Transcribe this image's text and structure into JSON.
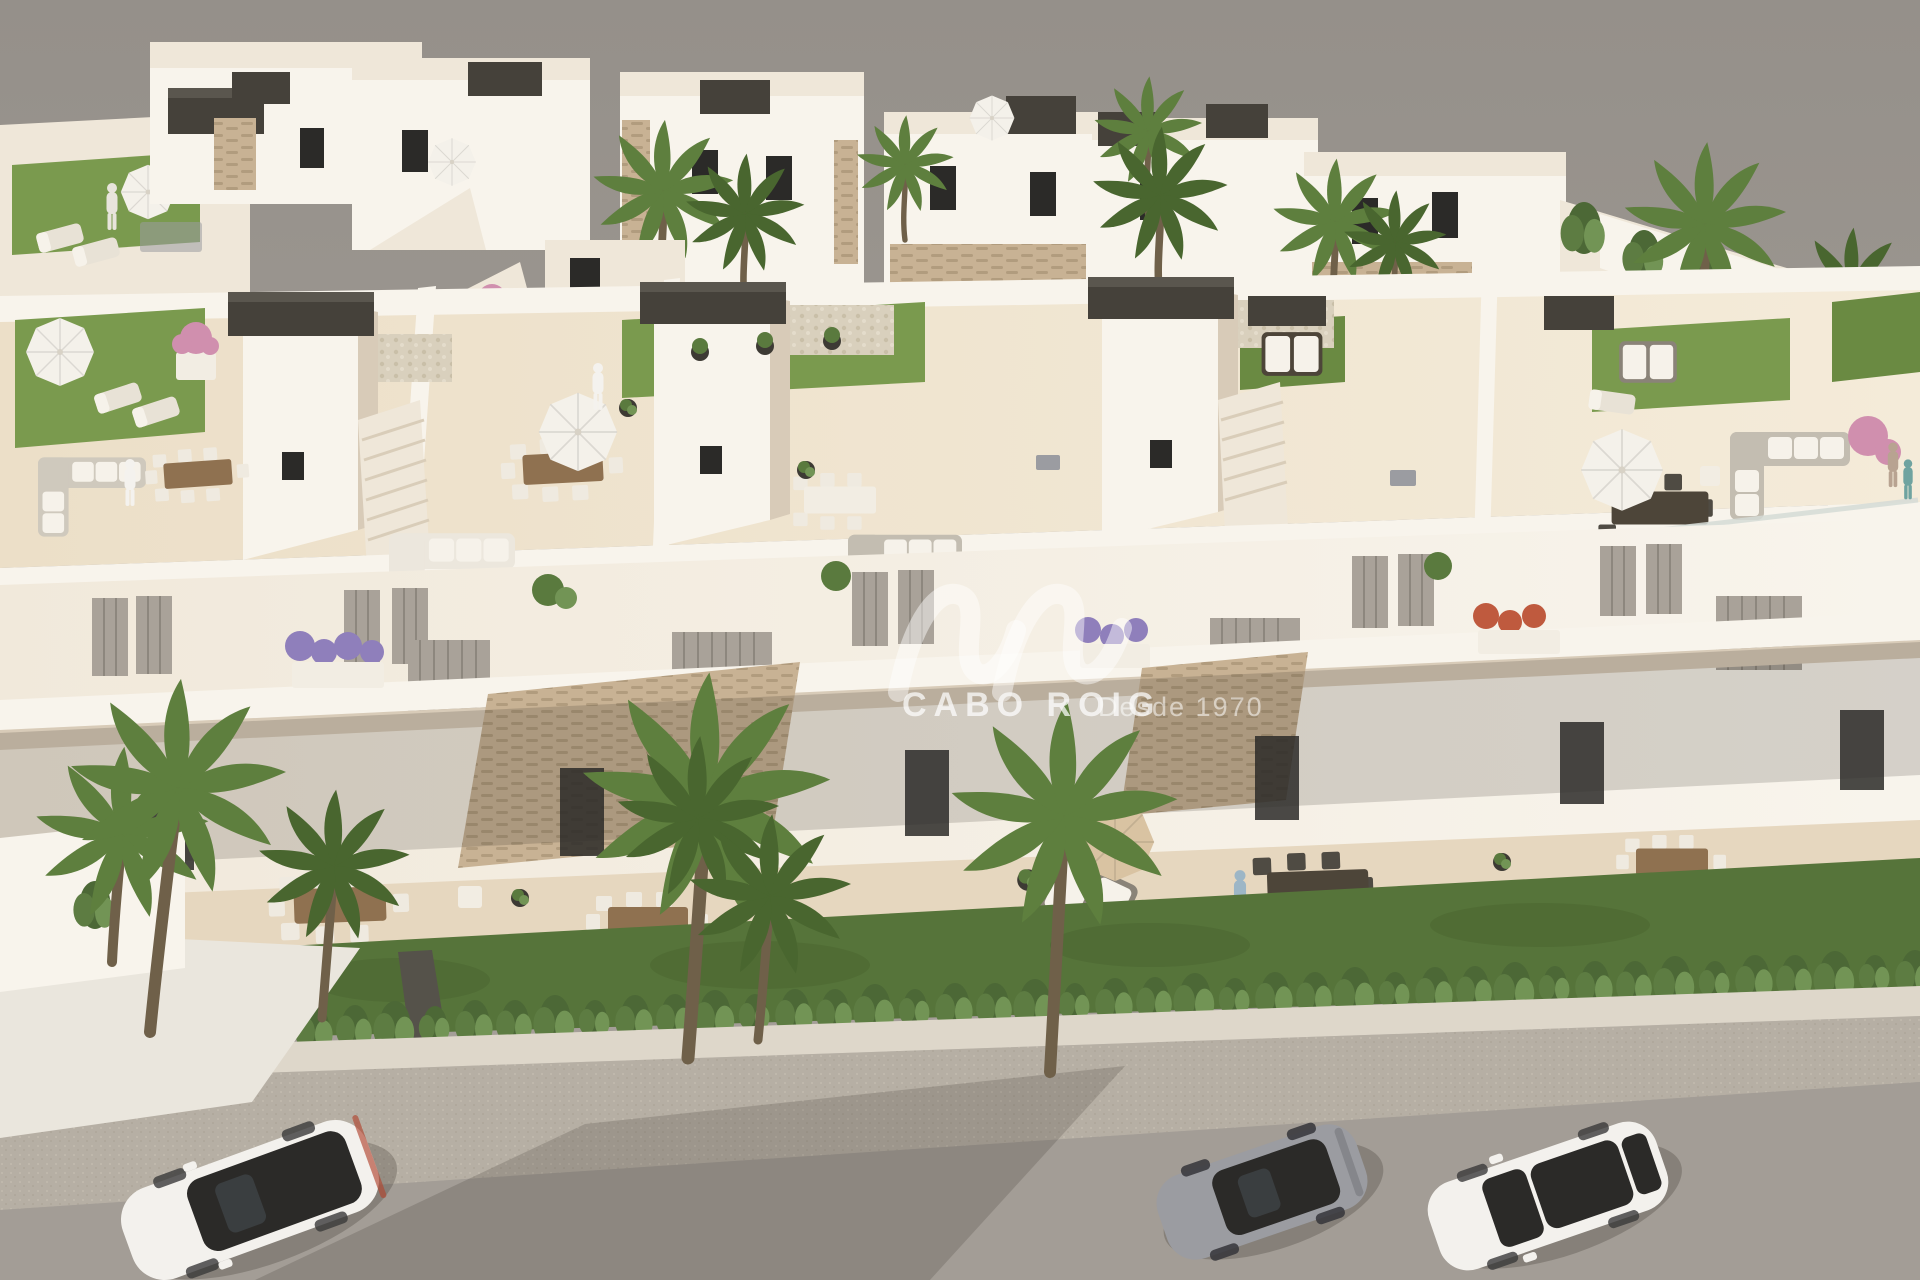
{
  "watermark": {
    "brand": "CABO ROIG",
    "tagline": "Desde 1970"
  },
  "scene": {
    "kind": "aerial-architectural-render",
    "elements": [
      "foreground block of white mediterranean townhouses with rooftop solarium terraces",
      "rooftop artificial turf patches, dark pergola caps, white parasols, lounge and dining furniture",
      "white facade with recessed slatted shutters, stone-clad canopies and flower planters",
      "ground-floor covered terraces with wooden dining sets, daybed and tan parasol",
      "lawn strip with cypress hedge, low white wall and tall palm trees along the street",
      "background row of detached white villas with tan stone accents, hedges and palms",
      "gray street in front with sidewalk and three parked cars",
      "small human figures on terraces"
    ],
    "vehicles": [
      {
        "name": "white-suv",
        "body": "white",
        "roof": "dark panoramic glass"
      },
      {
        "name": "gray-sports-coupe",
        "body": "gray",
        "roof": "dark glass"
      },
      {
        "name": "white-sedan",
        "body": "white",
        "roof": "white with dark sunroof"
      }
    ]
  },
  "colors": {
    "backdrop-top": "#95908a",
    "backdrop-bottom": "#a8a29b",
    "wall-bright": "#f8f4ec",
    "wall-soft": "#efe7d9",
    "wall-shade": "#d8cbb8",
    "roof-deck": "#ecdfc8",
    "roof-deck-light": "#f4ebd9",
    "terrace-floor": "#e6d7bf",
    "stone": "#c8b294",
    "stone-line": "#b19c7e",
    "pebble": "#d9d0bd",
    "pergola": "#45413a",
    "pergola-top": "#5a564e",
    "turf": "#7a9a4e",
    "turf-dark": "#6a8a42",
    "lawn": "#56743a",
    "lawn-dark": "#49632f",
    "hedge-dark": "#4c6836",
    "hedge-mid": "#5d7c42",
    "hedge-light": "#729455",
    "palm": "#5e7f3e",
    "palm-dark": "#49662f",
    "trunk": "#6f6049",
    "wood": "#8f7150",
    "wood-dark": "#4d4539",
    "white-furniture": "#f2ede3",
    "umbrella-tan": "#d9c3a2",
    "flower-purple": "#8f7fbb",
    "flower-pink": "#d08fae",
    "flower-red": "#bf5a3e",
    "shutter": "#a9a299",
    "glass": "#2b2a28",
    "road": "#a39d96",
    "sidewalk": "#b6afa4",
    "sidewalk-dot": "#c6bfb2",
    "driveway": "#eae6dd",
    "curb-wall": "#ded7ca",
    "car-white": "#f3f1ed",
    "car-gray": "#9b9ca1",
    "watermark": "#ffffff"
  }
}
